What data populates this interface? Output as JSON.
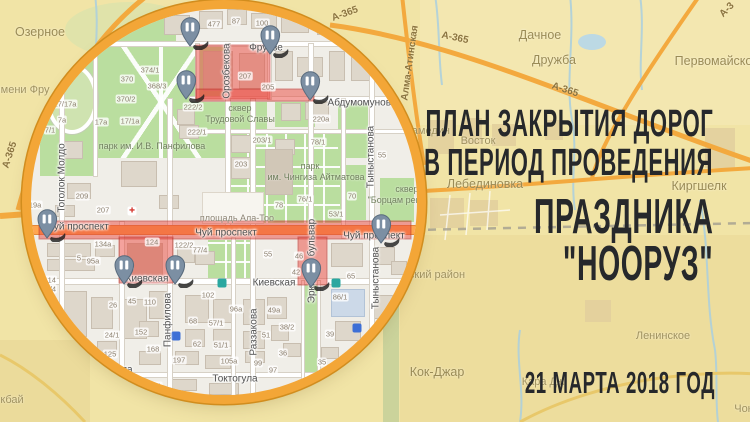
{
  "poster": {
    "title_line1": "ПЛАН ЗАКРЫТИЯ ДОРОГ",
    "title_line2": "В ПЕРИОД ПРОВЕДЕНИЯ",
    "title_line3": "ПРАЗДНИКА",
    "title_line4": "\"НООРУЗ\"",
    "date": "21 МАРТА 2018 ГОД"
  },
  "colors": {
    "background": "#f1e4a6",
    "ring": "#f3a637",
    "closure_red": "rgba(233,70,60,0.5)",
    "pin_blue": "#7c8fa3",
    "title_text": "#26282b",
    "park_green": "#bade9f",
    "road_orange": "#ffa64f"
  },
  "outer_map": {
    "labels": [
      {
        "t": "Озерное",
        "x": 40,
        "y": 32,
        "cls": "big"
      },
      {
        "t": "имени Фру",
        "x": 22,
        "y": 90,
        "cls": ""
      },
      {
        "t": "Дачное",
        "x": 540,
        "y": 35,
        "cls": "big"
      },
      {
        "t": "Дружба",
        "x": 554,
        "y": 60,
        "cls": "big"
      },
      {
        "t": "Первомайское",
        "x": 717,
        "y": 61,
        "cls": "big"
      },
      {
        "t": "Аламедин",
        "x": 424,
        "y": 131,
        "cls": ""
      },
      {
        "t": "Восток",
        "x": 478,
        "y": 141,
        "cls": ""
      },
      {
        "t": "Лебединовка",
        "x": 485,
        "y": 184,
        "cls": "big"
      },
      {
        "t": "Киргшелк",
        "x": 699,
        "y": 186,
        "cls": "big"
      },
      {
        "t": "ский район",
        "x": 437,
        "y": 275,
        "cls": ""
      },
      {
        "t": "Кок-Джар",
        "x": 437,
        "y": 372,
        "cls": "big"
      },
      {
        "t": "Ленинское",
        "x": 663,
        "y": 336,
        "cls": ""
      },
      {
        "t": "Кара Дж",
        "x": 543,
        "y": 382,
        "cls": ""
      },
      {
        "t": "кбай",
        "x": 12,
        "y": 400,
        "cls": ""
      },
      {
        "t": "Чон",
        "x": 744,
        "y": 409,
        "cls": ""
      }
    ],
    "road_labels": [
      {
        "t": "А-365",
        "x": 345,
        "y": 14,
        "rot": -20
      },
      {
        "t": "А-365",
        "x": 455,
        "y": 38,
        "rot": 12
      },
      {
        "t": "А-365",
        "x": 565,
        "y": 90,
        "rot": 18
      },
      {
        "t": "А-365",
        "x": 10,
        "y": 155,
        "rot": -72
      },
      {
        "t": "Алма-Атинская",
        "x": 410,
        "y": 63,
        "rot": -82
      },
      {
        "t": "А-3",
        "x": 727,
        "y": 10,
        "rot": -45
      }
    ]
  },
  "inner_map": {
    "street_labels": [
      {
        "t": "Фрунзе",
        "x": 266,
        "y": 48,
        "rot": 0
      },
      {
        "t": "Орозбекова",
        "x": 227,
        "y": 71,
        "rot": -90
      },
      {
        "t": "Абдумомунова",
        "x": 362,
        "y": 103,
        "rot": 0
      },
      {
        "t": "Тоголок Молдо",
        "x": 62,
        "y": 178,
        "rot": -90
      },
      {
        "t": "Чуй проспект",
        "x": 78,
        "y": 227,
        "rot": 0
      },
      {
        "t": "Чуй проспект",
        "x": 226,
        "y": 233,
        "rot": 0
      },
      {
        "t": "Чуй проспект",
        "x": 374,
        "y": 236,
        "rot": 0
      },
      {
        "t": "Киевская",
        "x": 147,
        "y": 279,
        "rot": 0
      },
      {
        "t": "Киевская",
        "x": 274,
        "y": 283,
        "rot": 0
      },
      {
        "t": "Токтогула",
        "x": 110,
        "y": 370,
        "rot": 0
      },
      {
        "t": "Токтогула",
        "x": 235,
        "y": 379,
        "rot": 0
      },
      {
        "t": "Панфилова",
        "x": 168,
        "y": 320,
        "rot": -90
      },
      {
        "t": "Раззакова",
        "x": 254,
        "y": 332,
        "rot": -90
      },
      {
        "t": "Эркиндик бульвар",
        "x": 312,
        "y": 261,
        "rot": -90
      },
      {
        "t": "Тыныстанова",
        "x": 371,
        "y": 157,
        "rot": -90
      },
      {
        "t": "Тыныстанова",
        "x": 376,
        "y": 278,
        "rot": -90
      },
      {
        "t": "ская",
        "x": 14,
        "y": 278,
        "rot": 0
      }
    ],
    "area_labels": [
      {
        "t": "парк им. И.В. Панфилова",
        "x": 152,
        "y": 146,
        "cls": ""
      },
      {
        "t": "сквер",
        "x": 240,
        "y": 108,
        "cls": ""
      },
      {
        "t": "Трудовой Славы",
        "x": 240,
        "y": 119,
        "cls": ""
      },
      {
        "t": "парк",
        "x": 310,
        "y": 166,
        "cls": ""
      },
      {
        "t": "им. Чингиза Айтматова",
        "x": 316,
        "y": 177,
        "cls": ""
      },
      {
        "t": "площадь Ала-Тоо",
        "x": 237,
        "y": 218,
        "cls": "plaza"
      },
      {
        "t": "сквер",
        "x": 407,
        "y": 189,
        "cls": ""
      },
      {
        "t": "\"Борцам рев",
        "x": 394,
        "y": 200,
        "cls": ""
      }
    ],
    "house_numbers": [
      {
        "t": "477",
        "x": 214,
        "y": 24
      },
      {
        "t": "87",
        "x": 236,
        "y": 21
      },
      {
        "t": "100",
        "x": 262,
        "y": 23
      },
      {
        "t": "207",
        "x": 245,
        "y": 76
      },
      {
        "t": "205",
        "x": 268,
        "y": 87
      },
      {
        "t": "222/2",
        "x": 193,
        "y": 107
      },
      {
        "t": "222/1",
        "x": 197,
        "y": 132
      },
      {
        "t": "203/1",
        "x": 262,
        "y": 140
      },
      {
        "t": "203",
        "x": 241,
        "y": 164
      },
      {
        "t": "220а",
        "x": 321,
        "y": 119
      },
      {
        "t": "78/1",
        "x": 318,
        "y": 142
      },
      {
        "t": "374/1",
        "x": 150,
        "y": 70
      },
      {
        "t": "370",
        "x": 127,
        "y": 79
      },
      {
        "t": "368/3",
        "x": 157,
        "y": 86
      },
      {
        "t": "370/2",
        "x": 126,
        "y": 99
      },
      {
        "t": "17/17а",
        "x": 65,
        "y": 104
      },
      {
        "t": "17а",
        "x": 101,
        "y": 122
      },
      {
        "t": "17/1а",
        "x": 130,
        "y": 121
      },
      {
        "t": "7а",
        "x": 62,
        "y": 120
      },
      {
        "t": "7/1",
        "x": 50,
        "y": 130
      },
      {
        "t": "209",
        "x": 82,
        "y": 196
      },
      {
        "t": "207",
        "x": 103,
        "y": 210
      },
      {
        "t": "219а",
        "x": 33,
        "y": 205
      },
      {
        "t": "134а",
        "x": 103,
        "y": 244
      },
      {
        "t": "124",
        "x": 152,
        "y": 242
      },
      {
        "t": "122/2",
        "x": 184,
        "y": 245
      },
      {
        "t": "77/4",
        "x": 200,
        "y": 250
      },
      {
        "t": "5",
        "x": 79,
        "y": 258
      },
      {
        "t": "95а",
        "x": 93,
        "y": 261
      },
      {
        "t": "93",
        "x": 129,
        "y": 266
      },
      {
        "t": "114",
        "x": 50,
        "y": 280
      },
      {
        "t": "112/4",
        "x": 47,
        "y": 289
      },
      {
        "t": "45",
        "x": 132,
        "y": 301
      },
      {
        "t": "110",
        "x": 150,
        "y": 302
      },
      {
        "t": "26",
        "x": 113,
        "y": 305
      },
      {
        "t": "102",
        "x": 208,
        "y": 295
      },
      {
        "t": "96а",
        "x": 236,
        "y": 309
      },
      {
        "t": "49а",
        "x": 274,
        "y": 310
      },
      {
        "t": "57/1",
        "x": 216,
        "y": 323
      },
      {
        "t": "68",
        "x": 193,
        "y": 321
      },
      {
        "t": "62",
        "x": 197,
        "y": 344
      },
      {
        "t": "51/1",
        "x": 221,
        "y": 345
      },
      {
        "t": "105а",
        "x": 229,
        "y": 361
      },
      {
        "t": "51",
        "x": 266,
        "y": 335
      },
      {
        "t": "36",
        "x": 283,
        "y": 353
      },
      {
        "t": "99",
        "x": 258,
        "y": 363
      },
      {
        "t": "97",
        "x": 273,
        "y": 370
      },
      {
        "t": "152",
        "x": 141,
        "y": 332
      },
      {
        "t": "24/1",
        "x": 112,
        "y": 335
      },
      {
        "t": "168",
        "x": 153,
        "y": 349
      },
      {
        "t": "125",
        "x": 110,
        "y": 354
      },
      {
        "t": "125/7",
        "x": 79,
        "y": 349
      },
      {
        "t": "197",
        "x": 179,
        "y": 360
      },
      {
        "t": "86/1",
        "x": 340,
        "y": 297
      },
      {
        "t": "39",
        "x": 330,
        "y": 334
      },
      {
        "t": "35",
        "x": 322,
        "y": 362
      },
      {
        "t": "38/2",
        "x": 287,
        "y": 327
      },
      {
        "t": "65",
        "x": 351,
        "y": 276
      },
      {
        "t": "46",
        "x": 299,
        "y": 256
      },
      {
        "t": "42",
        "x": 296,
        "y": 272
      },
      {
        "t": "55",
        "x": 268,
        "y": 254
      },
      {
        "t": "55",
        "x": 382,
        "y": 155
      },
      {
        "t": "76/1",
        "x": 305,
        "y": 199
      },
      {
        "t": "78",
        "x": 279,
        "y": 205
      },
      {
        "t": "53/1",
        "x": 336,
        "y": 214
      },
      {
        "t": "70",
        "x": 352,
        "y": 196
      },
      {
        "t": "164/1",
        "x": 152,
        "y": 386
      }
    ],
    "closures": [
      {
        "x": 197,
        "y": 46,
        "w": 72,
        "h": 52
      },
      {
        "x": 197,
        "y": 90,
        "w": 116,
        "h": 10
      },
      {
        "x": 40,
        "y": 222,
        "w": 370,
        "h": 16
      },
      {
        "x": 120,
        "y": 238,
        "w": 52,
        "h": 44
      },
      {
        "x": 299,
        "y": 238,
        "w": 27,
        "h": 46
      }
    ],
    "pins": [
      {
        "x": 190,
        "y": 46
      },
      {
        "x": 270,
        "y": 54
      },
      {
        "x": 186,
        "y": 99
      },
      {
        "x": 310,
        "y": 100
      },
      {
        "x": 47,
        "y": 238
      },
      {
        "x": 381,
        "y": 243
      },
      {
        "x": 124,
        "y": 284
      },
      {
        "x": 175,
        "y": 284
      },
      {
        "x": 311,
        "y": 287
      }
    ]
  }
}
